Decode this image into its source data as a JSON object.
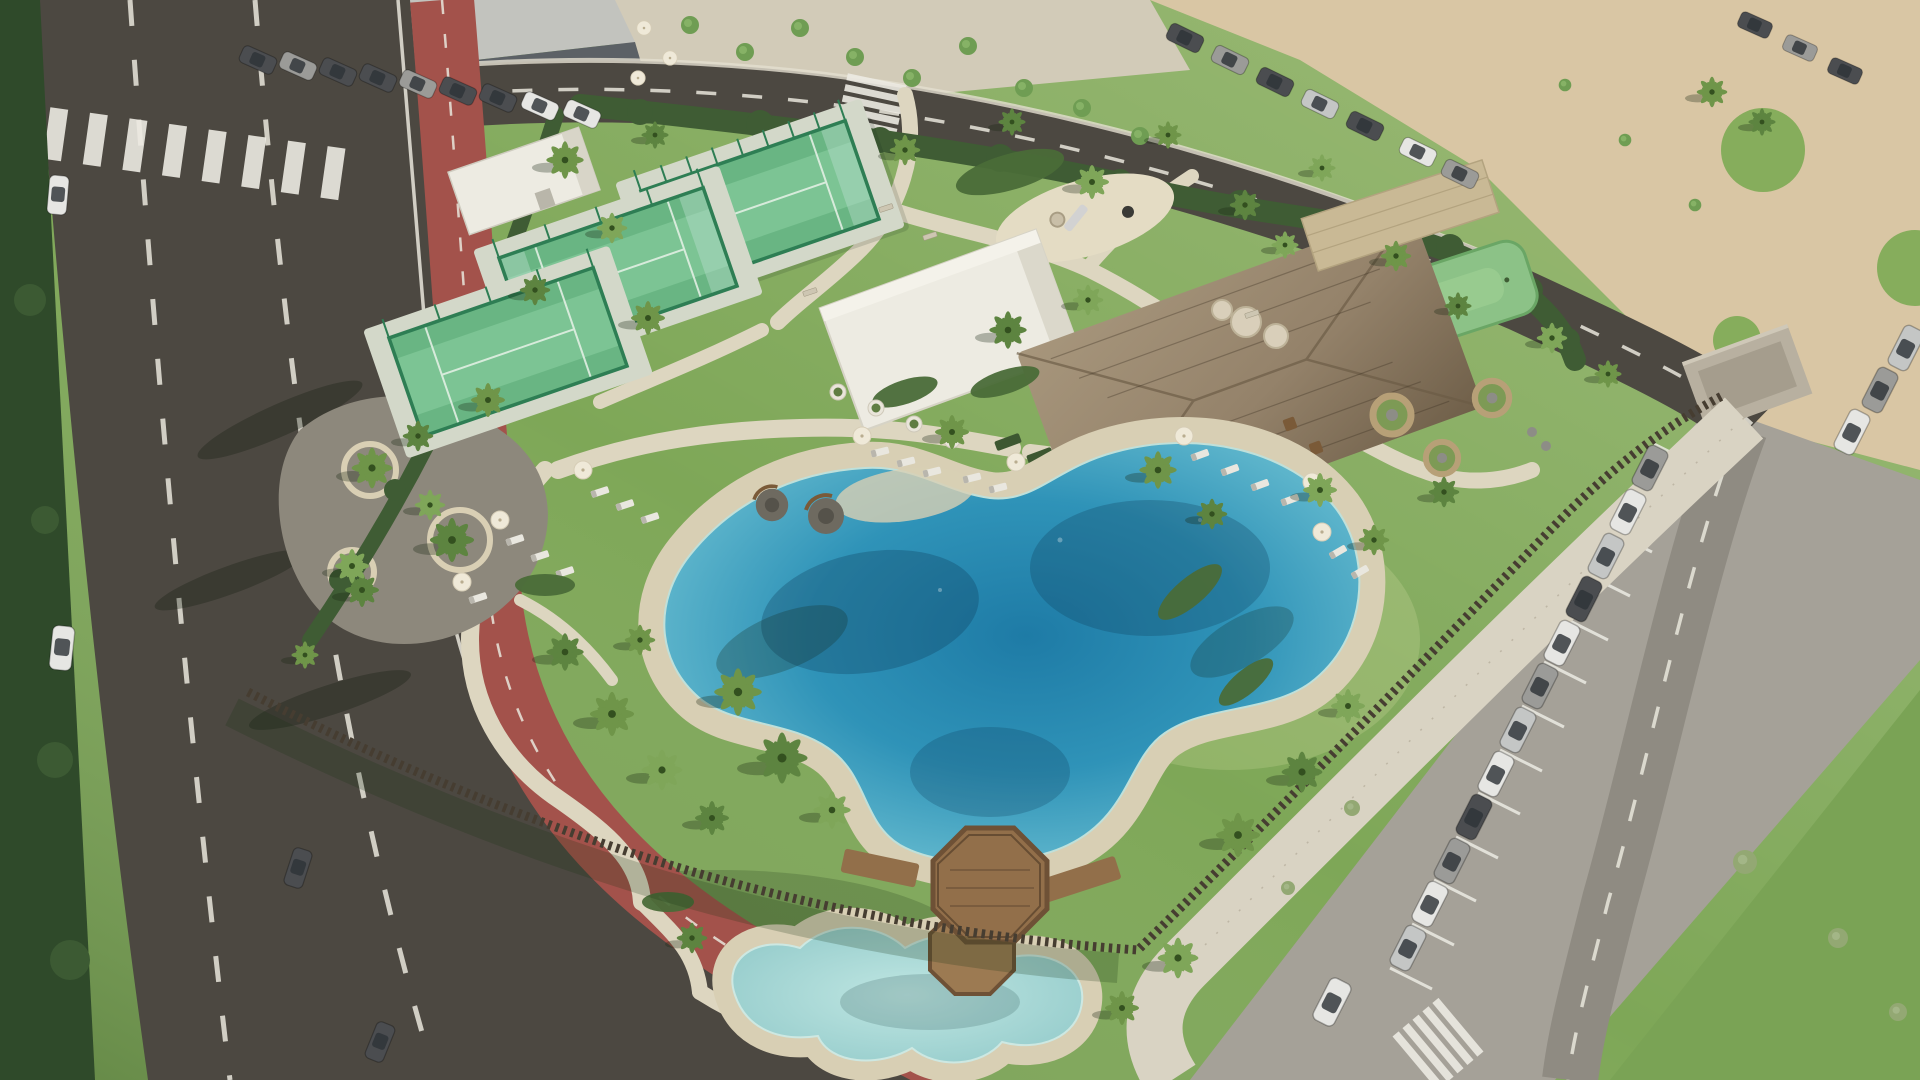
{
  "meta": {
    "title": "Aerial drone view of a coastal resort amenity park",
    "type": "photograph",
    "contains_text": false,
    "time_of_day": "sunny daytime, long shadows to the lower-left"
  },
  "colors": {
    "grass": "#7ea757",
    "grassDark": "#567c3b",
    "hedge": "#3f5c34",
    "asphalt": "#4c4841",
    "asphaltLight": "#8f8b82",
    "roadLine": "#e9e6dc",
    "bikeLane": "#a3524b",
    "path": "#ddd6c0",
    "promenade": "#d9d3c3",
    "sand": "#d8cfb4",
    "sandLot": "#d9c6a4",
    "poolMid": "#2f93b8",
    "poolDeep": "#1e7ba6",
    "kidsPool": "#9fd3d2",
    "court": "#7cc494",
    "courtDark": "#59a974",
    "cage": "#2e7e54",
    "courtPad": "#d3d8c9",
    "puttingGreen": "#8cc287",
    "thatch": "#9c8b70",
    "whiteBldg": "#edebe2",
    "deckWood": "#926f4a",
    "deckRail": "#6e5136",
    "parking": "#a5a198",
    "fence": "#463d31",
    "stoneWall": "#c9b995",
    "boulder": "#d9cfba",
    "gravel": "#8d887c",
    "buildingRoof": "#c2c3be",
    "buildingGlass": "#5c6166",
    "redSign": "#b23a2e"
  },
  "scene": {
    "park": {
      "label": "fenced resort amenity park",
      "padel_courts": {
        "count": 3,
        "cage": "green mesh and glass",
        "surface": "two-tone green"
      },
      "putting_green": {
        "count": 1
      },
      "playground": {
        "count": 1,
        "equipment": [
          "slide",
          "climber",
          "tire swing"
        ]
      },
      "picnic_area": {
        "surface": "gravel",
        "circular_tree_benches": 3
      },
      "clubhouse": {
        "white_flat_roof_building": 1,
        "thatched_pavilion": 1,
        "terrace_tables": 3
      },
      "storage_building": 1,
      "lagoon_pool": {
        "style": "freeform lagoon with sandy beach edge",
        "lobes": 2
      },
      "kids_pool": {
        "style": "freeform shallow wading pool"
      },
      "wooden_deck": {
        "shape": "octagonal",
        "bridges": 2
      },
      "sun_loungers": 18,
      "pool_umbrellas": 11,
      "cafe_umbrellas": 3,
      "wicker_cabanas": 3,
      "fire_pit_circles": 2,
      "olive_tree_planters": 4,
      "palm_trees_approx": 47,
      "perimeter": {
        "north_west": "clipped hedge",
        "south_east": "timber slat fence"
      }
    },
    "streets": {
      "left_road": {
        "lanes": 3,
        "markings": "white dashed lines",
        "crosswalks": 1
      },
      "cycle_lane": {
        "color_key": "bikeLane",
        "route": "parallel to left road, curving across the bottom"
      },
      "top_road": {
        "markings": "white dashed centerline",
        "crosswalks": 1
      },
      "right_road": {
        "markings": "white dashed centerline",
        "crosswalks": 1
      }
    },
    "parking": {
      "right_lot": {
        "angled_bays": true,
        "parked_cars": 15,
        "moving_cars": 1
      },
      "top_left_street": {
        "parked_cars": 9
      },
      "top_right_street": {
        "parked_cars": 10
      },
      "sand_lot": {
        "label": "unpaved sandy lot, top right"
      }
    },
    "vehicles_on_roads": {
      "white_car_left_road": 1,
      "white_van_bottom_left": 1,
      "dark_cars_bottom_left": 2
    },
    "top_left_block": {
      "building": "modern glass-front commercial building",
      "red_storefront_sign": 1,
      "plaza_trees": 9
    }
  }
}
